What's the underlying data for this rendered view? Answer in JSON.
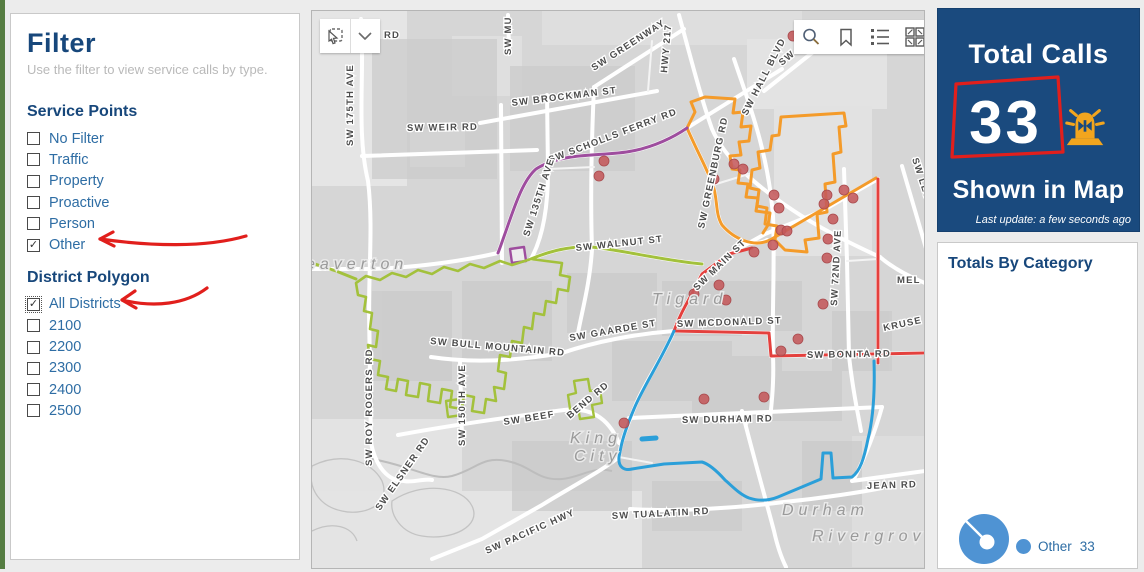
{
  "colors": {
    "accent_navy": "#17477b",
    "label_blue": "#2e6da4",
    "annotation_red": "#e11f1c",
    "donut_blue": "#4f93d3",
    "district_orange": "#f49b2a",
    "district_purple": "#9e4d9e",
    "district_green": "#a3c13c",
    "district_blue": "#2b9fd9",
    "road_red": "#e4403d",
    "dot_red": "#c4595b",
    "panel_navy": "#1a4a7e"
  },
  "sidebar": {
    "title": "Filter",
    "subtitle": "Use the filter to view service calls by type.",
    "sections": [
      {
        "id": "service_points",
        "header": "Service Points",
        "options": [
          {
            "label": "No Filter",
            "checked": false
          },
          {
            "label": "Traffic",
            "checked": false
          },
          {
            "label": "Property",
            "checked": false
          },
          {
            "label": "Proactive",
            "checked": false
          },
          {
            "label": "Person",
            "checked": false
          },
          {
            "label": "Other",
            "checked": true
          }
        ]
      },
      {
        "id": "district_polygon",
        "header": "District Polygon",
        "options": [
          {
            "label": "All Districts",
            "checked": true,
            "focused": true
          },
          {
            "label": "2100",
            "checked": false
          },
          {
            "label": "2200",
            "checked": false
          },
          {
            "label": "2300",
            "checked": false
          },
          {
            "label": "2400",
            "checked": false
          },
          {
            "label": "2500",
            "checked": false
          }
        ]
      }
    ]
  },
  "map": {
    "toolbar_left": [
      "select-tool",
      "dropdown-arrow"
    ],
    "toolbar_right": [
      "search",
      "bookmark",
      "legend-list",
      "basemap-grid"
    ],
    "street_labels": [
      {
        "t": "RD",
        "x": 72,
        "y": 27,
        "r": 0
      },
      {
        "t": "SW MU",
        "x": 199,
        "y": 44,
        "r": -90
      },
      {
        "t": "SW GREENWAY",
        "x": 282,
        "y": 60,
        "r": -33
      },
      {
        "t": "HWY 217",
        "x": 355,
        "y": 62,
        "r": -85
      },
      {
        "t": "SW OL",
        "x": 470,
        "y": 55,
        "r": -40
      },
      {
        "t": "SW BROCKMAN ST",
        "x": 200,
        "y": 95,
        "r": -7
      },
      {
        "t": "SW WEIR RD",
        "x": 95,
        "y": 120,
        "r": -1
      },
      {
        "t": "SW 175TH AVE",
        "x": 41,
        "y": 135,
        "r": -90
      },
      {
        "t": "SW SCHOLLS FERRY RD",
        "x": 238,
        "y": 152,
        "r": -21
      },
      {
        "t": "SW HALL BLVD",
        "x": 435,
        "y": 105,
        "r": -63
      },
      {
        "t": "SW GREENBURG RD",
        "x": 392,
        "y": 218,
        "r": -78
      },
      {
        "t": "SW 135TH AVE",
        "x": 217,
        "y": 226,
        "r": -72
      },
      {
        "t": "SW WALNUT ST",
        "x": 264,
        "y": 240,
        "r": -6
      },
      {
        "t": "SW MAIN ST",
        "x": 385,
        "y": 280,
        "r": -44
      },
      {
        "t": "SW 72ND AVE",
        "x": 525,
        "y": 295,
        "r": -87
      },
      {
        "t": "SW GAARDE ST",
        "x": 258,
        "y": 330,
        "r": -10
      },
      {
        "t": "SW MCDONALD ST",
        "x": 365,
        "y": 316,
        "r": -2
      },
      {
        "t": "SW BONITA RD",
        "x": 495,
        "y": 347,
        "r": -1
      },
      {
        "t": "SW BULL MOUNTAIN RD",
        "x": 118,
        "y": 333,
        "r": 5
      },
      {
        "t": "SW BEEF",
        "x": 192,
        "y": 414,
        "r": -9
      },
      {
        "t": "BEND RD",
        "x": 258,
        "y": 408,
        "r": -40
      },
      {
        "t": "SW DURHAM RD",
        "x": 370,
        "y": 412,
        "r": -1
      },
      {
        "t": "SW ROY ROGERS RD",
        "x": 60,
        "y": 455,
        "r": -90
      },
      {
        "t": "SW 150TH AVE",
        "x": 153,
        "y": 435,
        "r": -90
      },
      {
        "t": "SW ELSNER RD",
        "x": 68,
        "y": 500,
        "r": -55
      },
      {
        "t": "SW PACIFIC HWY",
        "x": 175,
        "y": 543,
        "r": -24
      },
      {
        "t": "SW TUALATIN RD",
        "x": 300,
        "y": 508,
        "r": -3
      },
      {
        "t": "JEAN RD",
        "x": 555,
        "y": 478,
        "r": -2
      },
      {
        "t": "KRUSE",
        "x": 572,
        "y": 320,
        "r": -12
      },
      {
        "t": "MEL",
        "x": 585,
        "y": 272,
        "r": 0
      },
      {
        "t": "SW LESSER R",
        "x": 600,
        "y": 148,
        "r": 72
      }
    ],
    "city_labels": [
      {
        "t": "eaverton",
        "x": -6,
        "y": 258
      },
      {
        "t": "Tigard",
        "x": 340,
        "y": 293
      },
      {
        "t": "King",
        "x": 258,
        "y": 432
      },
      {
        "t": "City",
        "x": 262,
        "y": 450
      },
      {
        "t": "Durham",
        "x": 470,
        "y": 504
      },
      {
        "t": "Rivergrove",
        "x": 500,
        "y": 530
      }
    ],
    "dots": [
      [
        292,
        150
      ],
      [
        287,
        165
      ],
      [
        422,
        153
      ],
      [
        431,
        158
      ],
      [
        402,
        168
      ],
      [
        462,
        184
      ],
      [
        467,
        197
      ],
      [
        515,
        184
      ],
      [
        532,
        179
      ],
      [
        541,
        187
      ],
      [
        512,
        193
      ],
      [
        521,
        208
      ],
      [
        469,
        219
      ],
      [
        475,
        220
      ],
      [
        461,
        234
      ],
      [
        516,
        228
      ],
      [
        442,
        241
      ],
      [
        515,
        247
      ],
      [
        407,
        274
      ],
      [
        382,
        283
      ],
      [
        414,
        289
      ],
      [
        511,
        293
      ],
      [
        486,
        328
      ],
      [
        469,
        340
      ],
      [
        392,
        388
      ],
      [
        452,
        386
      ],
      [
        312,
        412
      ],
      [
        481,
        25
      ]
    ],
    "boundaries": [
      {
        "name": "2100-orange-road",
        "color": "#f49b2a",
        "w": 3,
        "path": "M375,117 C385,140 395,158 401,174 C406,190 403,202 410,214 C422,228 442,237 458,229 L564,167"
      },
      {
        "name": "2100-orange-left-lobe",
        "color": "#f49b2a",
        "w": 3,
        "path": "M375,117 L383,101 L379,91 L393,86 L423,88 L421,102 L431,101 L429,116 L439,115 L437,130 L427,131 L429,144 L418,145 L420,158 L428,159 L426,172 L436,173 L434,186 L446,187 L444,200 L458,202 L456,214 L451,222"
      },
      {
        "name": "2100-orange-right-lobe",
        "color": "#f49b2a",
        "w": 3,
        "path": "M469,106 L532,102 L534,115 L527,116 L529,141 L521,143 L523,171 L513,173 L515,201 L505,203 L507,227 L493,229 L495,241 L473,239 L463,229 L465,215 L453,213 L455,197 L445,195 L447,179 L438,177 L440,159 L448,157 L446,141 L458,139 L460,125 L467,124 Z"
      },
      {
        "name": "2200-purple",
        "color": "#9e4d9e",
        "w": 3,
        "path": "M186,242 C200,205 208,172 224,158 C252,140 292,146 320,140 C342,136 362,126 375,117"
      },
      {
        "name": "2200-purple-square",
        "color": "#9e4d9e",
        "w": 2.4,
        "fill": "#ececec",
        "path": "M198,238 L212,236 L214,250 L200,252 Z"
      },
      {
        "name": "2300-green-walnut",
        "color": "#a3c13c",
        "w": 3,
        "path": "M219,248 C245,237 268,234 288,237 C318,241 356,250 390,253"
      },
      {
        "name": "2300-green-west",
        "color": "#a3c13c",
        "w": 3,
        "path": "M0,252 L24,260 L44,268"
      },
      {
        "name": "2300-green-polygon",
        "color": "#a3c13c",
        "w": 2.6,
        "path": "M219,248 L200,254 L188,250 L172,257 L158,253 L146,260 L132,256 L120,263 L106,259 L94,266 L80,262 L68,269 L54,265 L44,272 L46,284 L54,286 L52,300 L60,302 L58,318 L66,320 L64,336 L56,334 L58,348 L68,350 L66,364 L76,366 L74,378 L84,380 L86,368 L96,370 L94,384 L106,386 L108,372 L118,374 L116,390 L128,392 L130,378 L140,380 L138,396 L150,398 L152,384 L162,386 L160,400 L172,402 L174,388 L184,390 L182,376 L192,378 L194,362 L186,360 L188,344 L198,346 L200,330 L210,332 L212,316 L220,318 L222,302 L232,304 L234,290 L244,292 L246,278 L256,280 L258,266 L248,264 L250,252 L234,250 Z"
      },
      {
        "name": "2300-green-bit-a",
        "color": "#a3c13c",
        "w": 2.4,
        "path": "M262,370 L276,368 L278,380 L288,378 L290,392 L280,394 L282,406 L268,408 L266,396 L258,398 L256,384 L264,382 Z"
      },
      {
        "name": "2300-green-bit-b",
        "color": "#a3c13c",
        "w": 2.4,
        "path": "M134,390 L148,388 L150,404 L136,406 Z"
      },
      {
        "name": "2400-red-i5",
        "color": "#e4403d",
        "w": 3,
        "path": "M566,168 L566,352"
      },
      {
        "name": "2400-red-99w",
        "color": "#e4403d",
        "w": 3,
        "path": "M440,237 L417,243 L390,263 C378,288 369,300 362,320"
      },
      {
        "name": "2400-red-mcdonald-bonita",
        "color": "#e4403d",
        "w": 3,
        "path": "M362,320 L457,322 L459,345 L613,342"
      },
      {
        "name": "2500-blue",
        "color": "#2b9fd9",
        "w": 3,
        "path": "M562,350 C563,382 561,408 556,428 C552,448 548,460 540,466 L521,467 L519,442 L511,442 L509,468 L466,486 C456,490 446,490 437,487 C427,483 419,474 413,469 C404,459 397,453 390,451 L352,453 L320,458 C312,460 306,456 307,446 L309,436 C311,426 316,412 322,398 C330,378 348,351 362,320"
      },
      {
        "name": "2500-blue-bar",
        "color": "#2b9fd9",
        "w": 5,
        "path": "M330,428 L344,427"
      }
    ]
  },
  "total_calls": {
    "title": "Total Calls",
    "value": "33",
    "subtitle": "Shown in Map",
    "last_update": "Last update: a few seconds ago"
  },
  "category_panel": {
    "header": "Totals By Category",
    "legend": [
      {
        "label": "Other",
        "value": "33"
      }
    ]
  },
  "chart_data": {
    "type": "pie",
    "title": "Totals By Category",
    "categories": [
      "Other"
    ],
    "values": [
      33
    ],
    "colors": [
      "#4f93d3"
    ],
    "legend_position": "right",
    "donut": true
  }
}
